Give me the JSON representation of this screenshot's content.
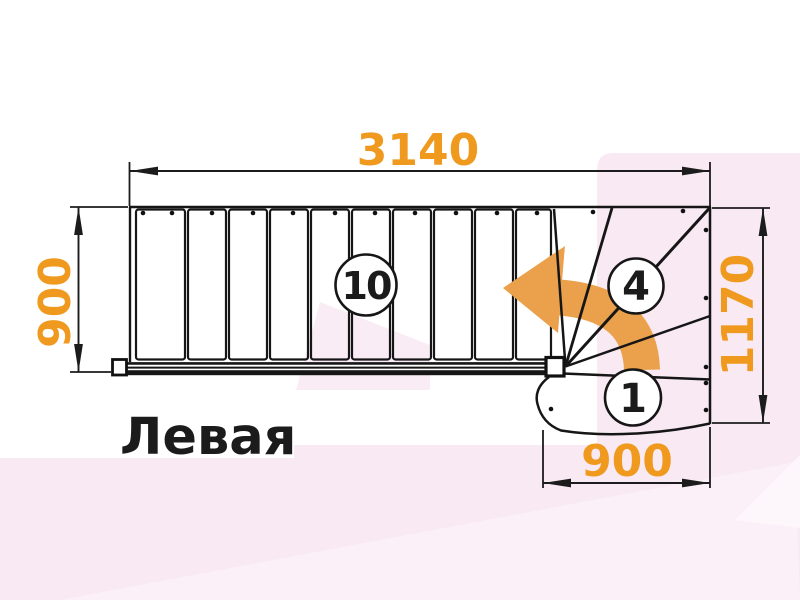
{
  "diagram": {
    "type": "stair-plan-top-view",
    "variant_label": "Левая",
    "dimensions": {
      "top_width_mm": "3140",
      "left_depth_mm": "900",
      "right_height_mm": "1170",
      "bottom_width_mm": "900"
    },
    "step_counts": {
      "straight_steps": "10",
      "winder_steps": "4",
      "first_step": "1"
    },
    "colors": {
      "dimension_text": "#ef9a1f",
      "turn_arrow": "#eba14b",
      "drawing_lines": "#161616",
      "background_pink": "#f8e9f3"
    }
  }
}
